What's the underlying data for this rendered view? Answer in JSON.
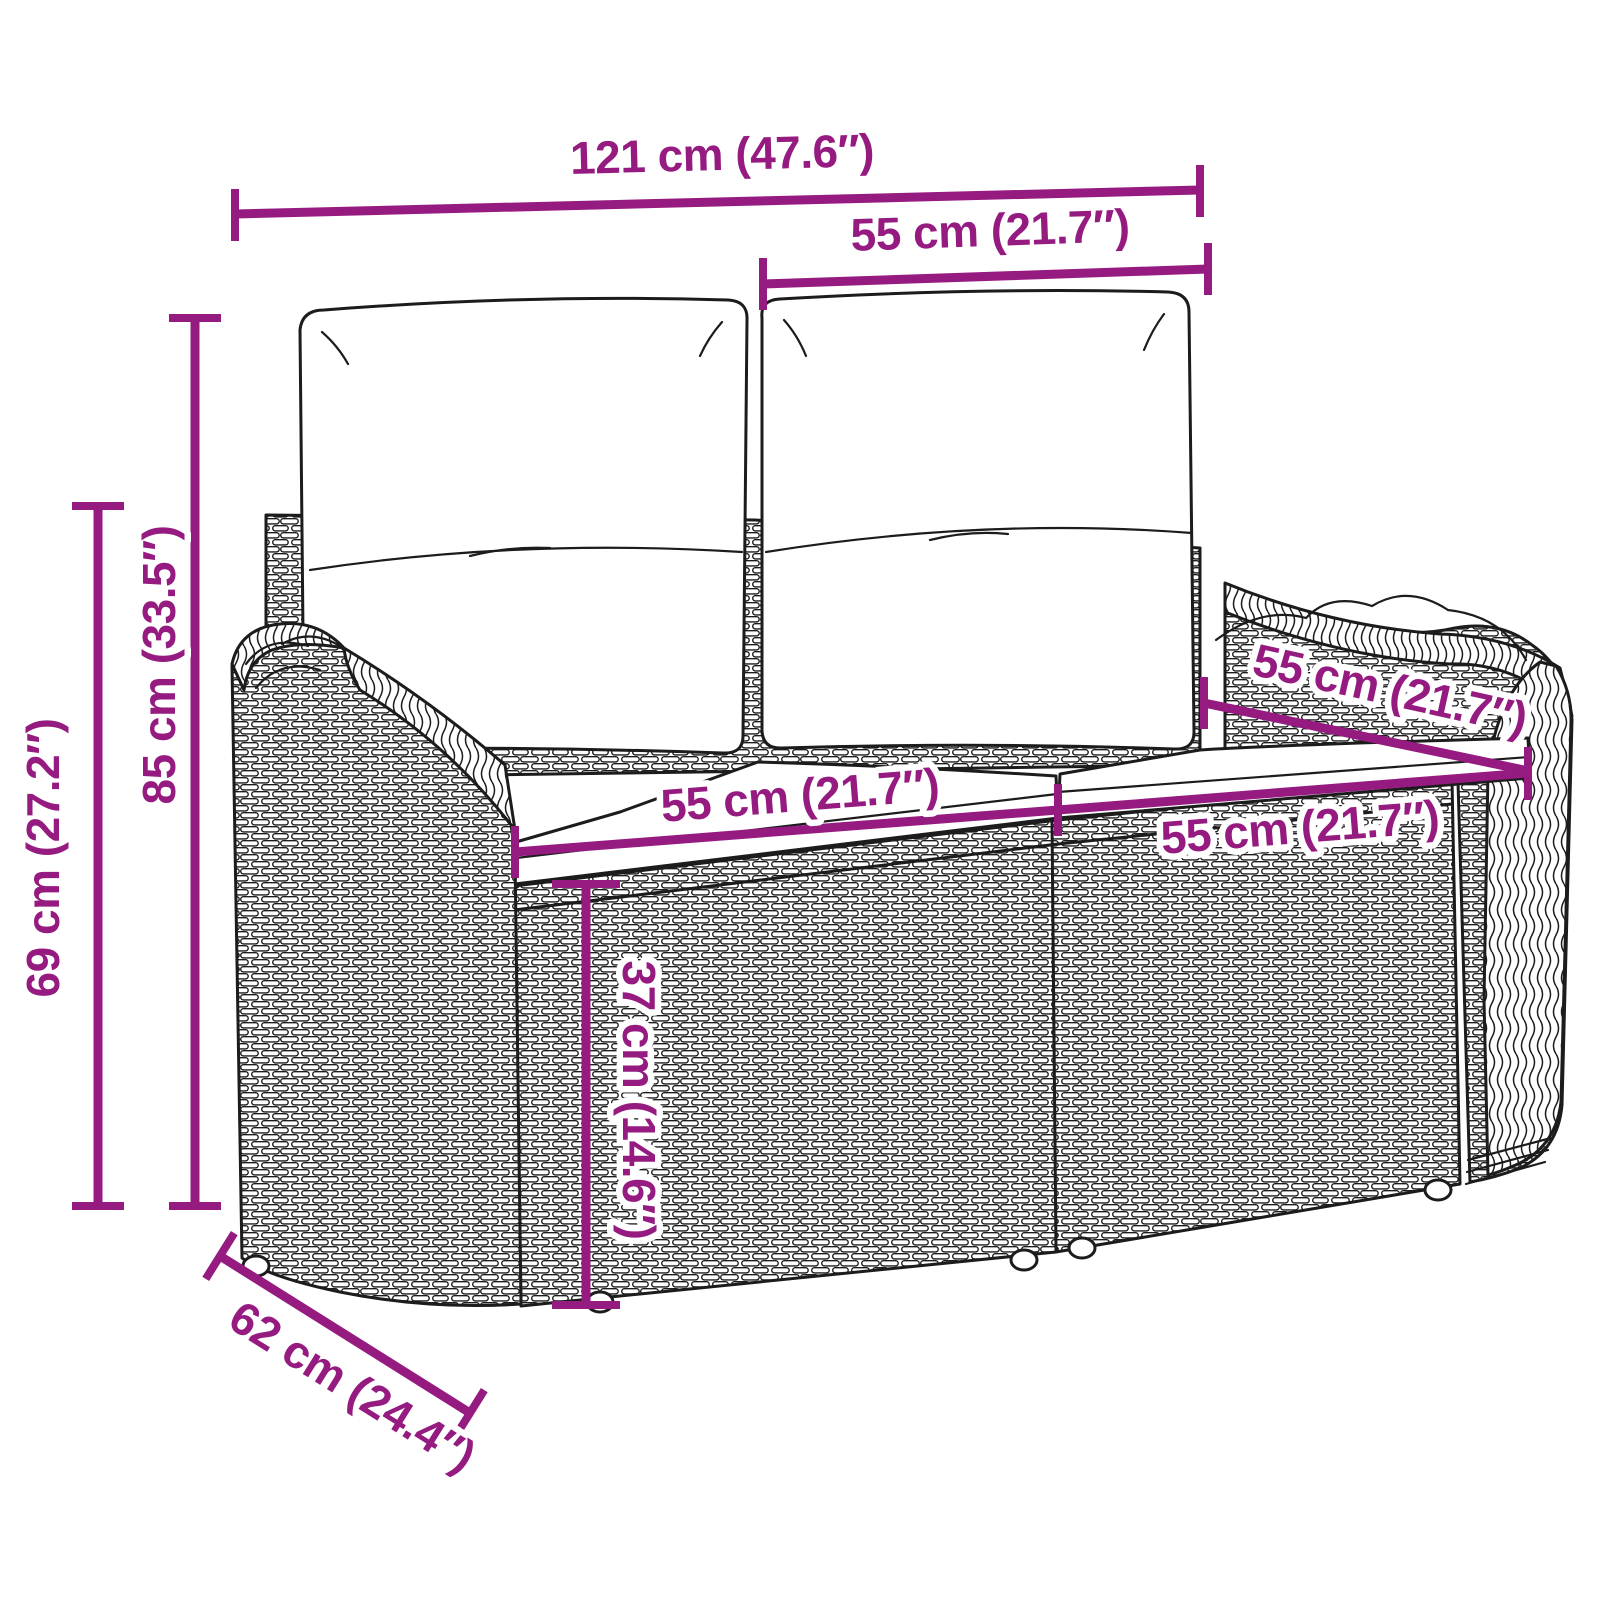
{
  "diagram": {
    "type": "product-dimension-diagram",
    "subject": "poly rattan 2-seater garden bench with back and seat cushions",
    "background_color": "#ffffff",
    "accent_color": "#951B81",
    "line_art_color": "#1c1c1c"
  },
  "dimensions": {
    "overall_width": {
      "label": "121 cm (47.6″)",
      "value_cm": 121,
      "value_in": 47.6
    },
    "back_cushion_width": {
      "label": "55 cm (21.7″)",
      "value_cm": 55,
      "value_in": 21.7
    },
    "overall_height": {
      "label": "85 cm (33.5″)",
      "value_cm": 85,
      "value_in": 33.5
    },
    "armrest_height": {
      "label": "69 cm (27.2″)",
      "value_cm": 69,
      "value_in": 27.2
    },
    "seat_width_left": {
      "label": "55 cm (21.7″)",
      "value_cm": 55,
      "value_in": 21.7
    },
    "seat_width_right": {
      "label": "55 cm (21.7″)",
      "value_cm": 55,
      "value_in": 21.7
    },
    "seat_depth": {
      "label": "55 cm (21.7″)",
      "value_cm": 55,
      "value_in": 21.7
    },
    "seat_height": {
      "label": "37 cm (14.6″)",
      "value_cm": 37,
      "value_in": 14.6
    },
    "overall_depth": {
      "label": "62 cm (24.4″)",
      "value_cm": 62,
      "value_in": 24.4
    }
  }
}
